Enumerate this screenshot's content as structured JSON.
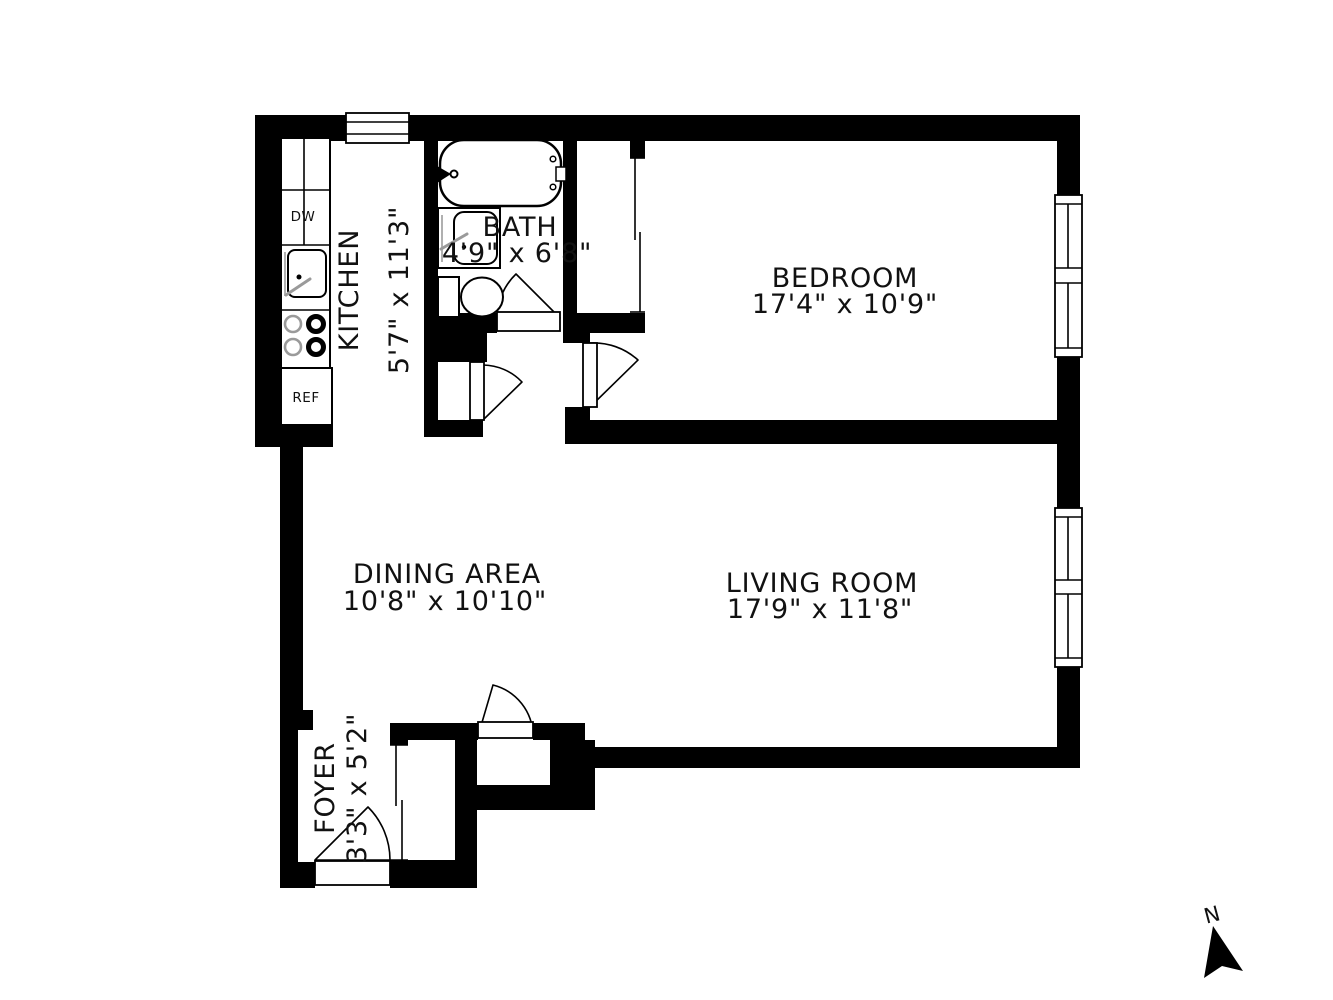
{
  "document": {
    "type": "apartment floor plan"
  },
  "rooms": {
    "kitchen": {
      "name": "KITCHEN",
      "dims": "5'7\" x 11'3\""
    },
    "bath": {
      "name": "BATH",
      "dims": "4'9\" x 6'8\""
    },
    "bedroom": {
      "name": "BEDROOM",
      "dims": "17'4\" x 10'9\""
    },
    "dining": {
      "name": "DINING AREA",
      "dims": "10'8\" x 10'10\""
    },
    "living": {
      "name": "LIVING ROOM",
      "dims": "17'9\" x 11'8\""
    },
    "foyer": {
      "name": "FOYER",
      "dims": "3'3\" x 5'2\""
    }
  },
  "appliances": {
    "dishwasher": "DW",
    "refrigerator": "REF"
  },
  "compass": {
    "north": "N"
  },
  "colors": {
    "wall": "#000000",
    "background": "#ffffff",
    "text": "#111111",
    "fixture_gray": "#9a9a9a"
  }
}
